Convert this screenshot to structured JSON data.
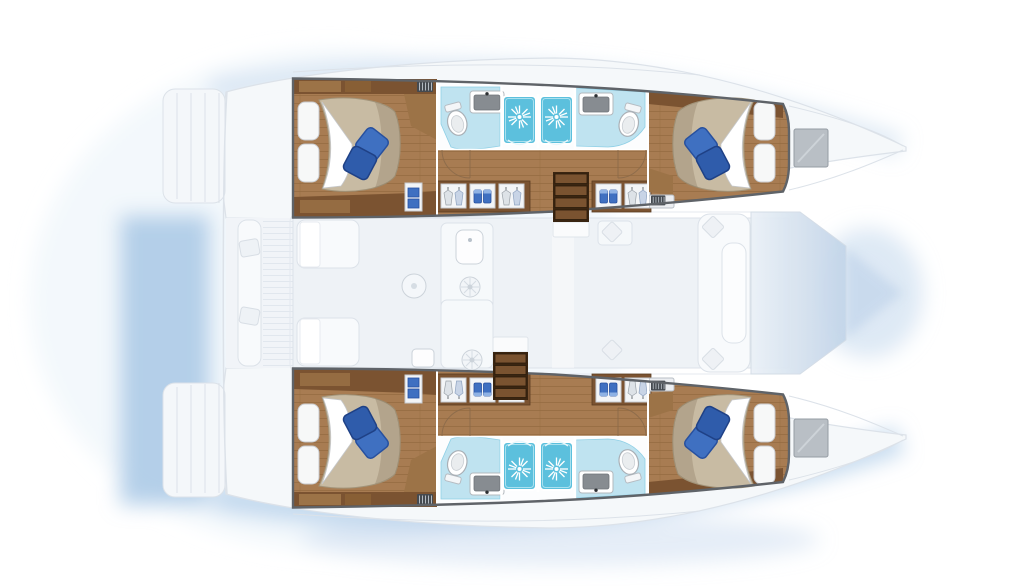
{
  "diagram": {
    "type": "yacht-floor-plan",
    "vessel": "catamaran",
    "view": "top-down-deck-plan",
    "orientation": {
      "bow": "right",
      "stern": "left",
      "port_hull": "top",
      "starboard_hull": "bottom"
    }
  },
  "palette": {
    "background": "#ffffff",
    "glow": "#9fc1e3",
    "glow_soft": "#c8daee",
    "ghost_fill": "#f5f8fa",
    "ghost_line": "#dce2e9",
    "saloon_floor": "#eef2f6",
    "window_blue": "#c2d4e8",
    "window_blue_light": "#ebf1f7",
    "wood_floor": "#a87c52",
    "wood_plank": "#8a6138",
    "cabinet_dark": "#7b5331",
    "cabinet_light": "#9c7347",
    "step_base": "#3a2511",
    "step_tread": "#7a5330",
    "interior_border": "#5f6368",
    "bed_duvet": "#c8bba3",
    "bed_duvet_edge": "#a2947a",
    "pillow_white": "#f7f8f8",
    "pillow_blue": "#3f70c1",
    "pillow_blue_dark": "#27509f",
    "bath_floor": "#bfe3f0",
    "shower_floor": "#5cc0dd",
    "sink_basin": "#878c91",
    "hatch_gray": "#b9bfc5"
  },
  "rooms": [
    {
      "id": "port-aft-cabin",
      "type": "double-berth-cabin"
    },
    {
      "id": "port-aft-bathroom",
      "type": "bathroom-with-shower"
    },
    {
      "id": "port-forward-bathroom",
      "type": "bathroom-with-shower"
    },
    {
      "id": "port-forward-cabin",
      "type": "double-berth-cabin"
    },
    {
      "id": "starboard-aft-cabin",
      "type": "double-berth-cabin"
    },
    {
      "id": "starboard-aft-bathroom",
      "type": "bathroom-with-shower"
    },
    {
      "id": "starboard-forward-bathroom",
      "type": "bathroom-with-shower"
    },
    {
      "id": "starboard-forward-cabin",
      "type": "double-berth-cabin"
    },
    {
      "id": "saloon",
      "type": "bridgedeck-saloon-galley"
    },
    {
      "id": "aft-cockpit",
      "type": "cockpit"
    },
    {
      "id": "foredeck",
      "type": "bow-area"
    }
  ],
  "fixtures": {
    "double_berths": 4,
    "blue_accent_pillows_per_berth": 2,
    "shower_stalls": 4,
    "toilets": 4,
    "washbasins": 4,
    "companionway_steps": 2,
    "wardrobe_niches": 10,
    "deck_hatches": 2
  }
}
